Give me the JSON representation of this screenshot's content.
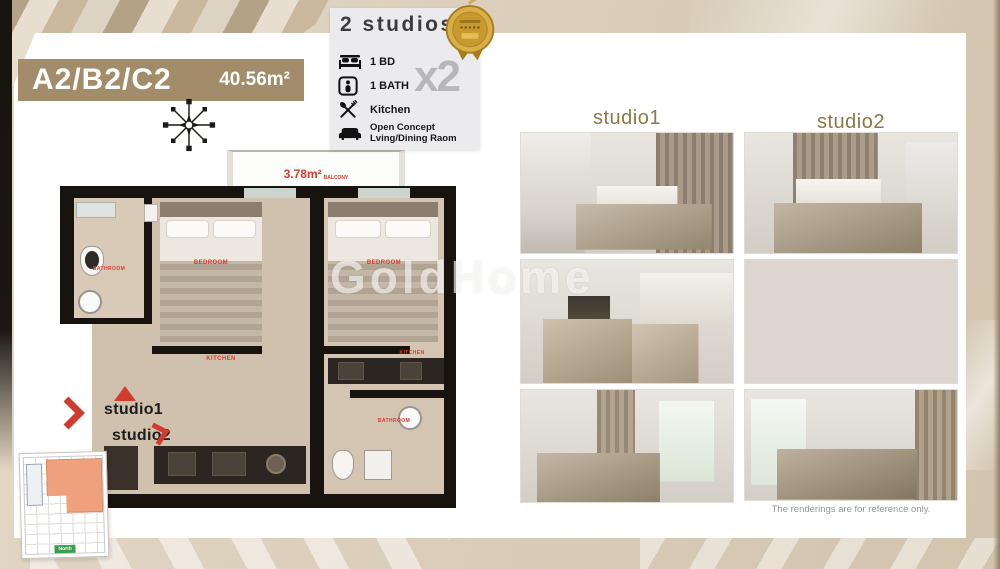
{
  "title_banner": {
    "units": "A2/B2/C2",
    "area": "40.56m²",
    "bg_color": "#a28c6a"
  },
  "features": {
    "heading": "2 studios",
    "multiplier": "x2",
    "items": [
      {
        "icon": "bed-icon",
        "label": "1 BD"
      },
      {
        "icon": "bath-icon",
        "label": "1 BATH"
      },
      {
        "icon": "kitchen-icon",
        "label": "Kitchen"
      },
      {
        "icon": "sofa-icon",
        "label": "Open Concept Lving/Dining Raom"
      }
    ]
  },
  "floor_plan": {
    "balcony_area": "3.78m²",
    "balcony_label": "BALCONY",
    "left_unit": {
      "bathroom": "BATHROOM",
      "bedroom": "BEDROOM",
      "kitchen": "KITCHEN"
    },
    "right_unit": {
      "bedroom": "BEDROOM",
      "kitchen": "KITCHEN",
      "bathroom": "BATHROOM"
    },
    "pointer1": "studio1",
    "pointer2": "studio2",
    "minimap_label": "North"
  },
  "gallery": {
    "col1_header": "studio1",
    "col2_header": "studio2",
    "photos": [
      "bedroom-with-kitchenette",
      "bedroom-slat-wall",
      "bedroom-tv-and-kitchen",
      "bedroom-large-window",
      "bedroom-window-greenery",
      "bedroom-with-nightstand"
    ],
    "disclaimer": "The renderings are for reference only."
  },
  "watermark": "GoldHome",
  "colors": {
    "accent_red": "#d23c30",
    "banner_tan": "#a28c6a",
    "gallery_header_olive": "#8a7948",
    "badge_gold": "#d9ae46",
    "background_beige": "#ddd2c1"
  }
}
